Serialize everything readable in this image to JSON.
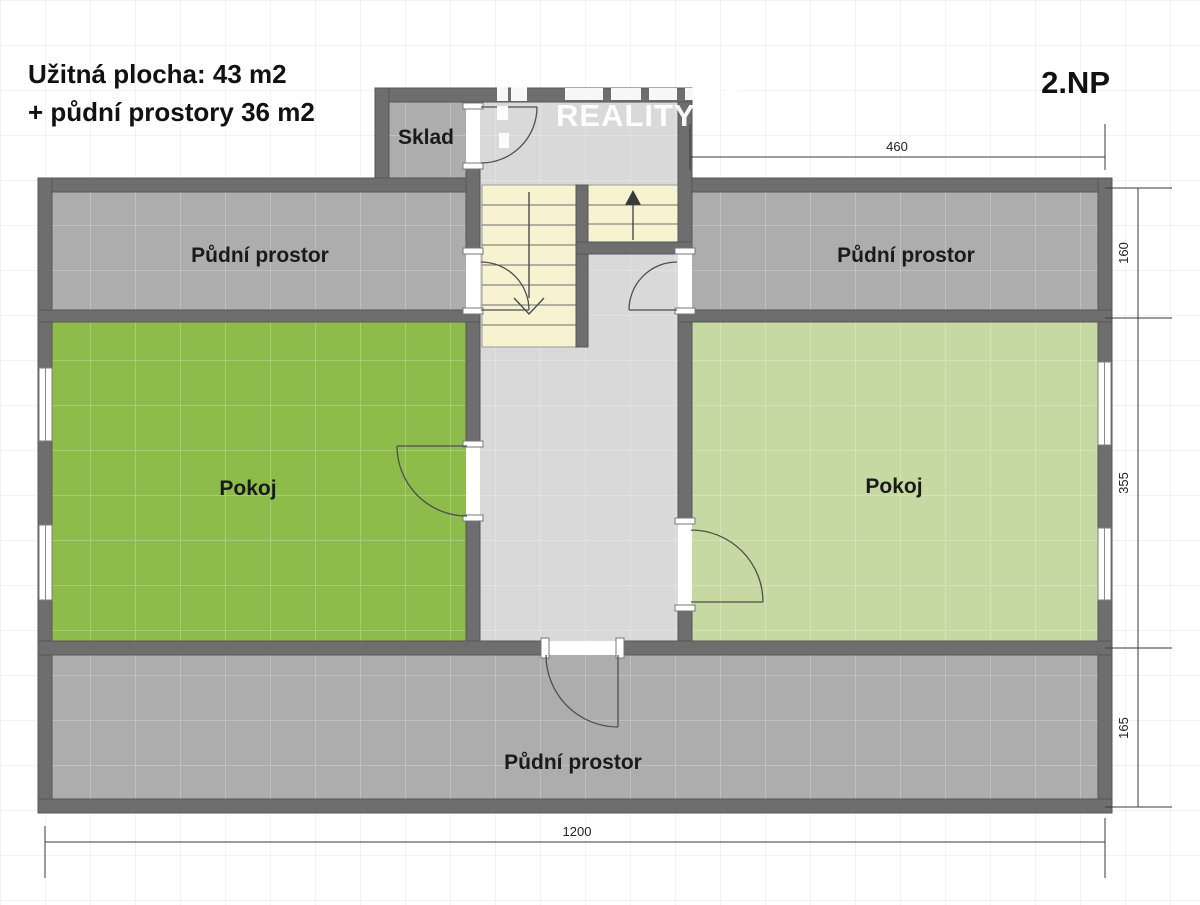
{
  "title": {
    "line1": "Užitná plocha: 43 m2",
    "line2": "+ půdní prostory 36 m2"
  },
  "floor_label": "2.NP",
  "watermark": {
    "text": "REALITY"
  },
  "rooms": {
    "sklad": "Sklad",
    "attic_left": "Půdní prostor",
    "attic_right": "Půdní prostor",
    "attic_bottom": "Půdní prostor",
    "room_left": "Pokoj",
    "room_right": "Pokoj"
  },
  "dimensions": {
    "top_width": "460",
    "right_top": "160",
    "right_middle": "355",
    "right_bottom": "165",
    "bottom_width": "1200"
  },
  "colors": {
    "wall": "#6e6e6e",
    "attic": "#adadad",
    "room_left": "#8dbc4b",
    "room_right": "#c7d9a3",
    "hall": "#d9d9d9",
    "stairs": "#f7f3d0",
    "dim_line": "#3a3a3a"
  }
}
